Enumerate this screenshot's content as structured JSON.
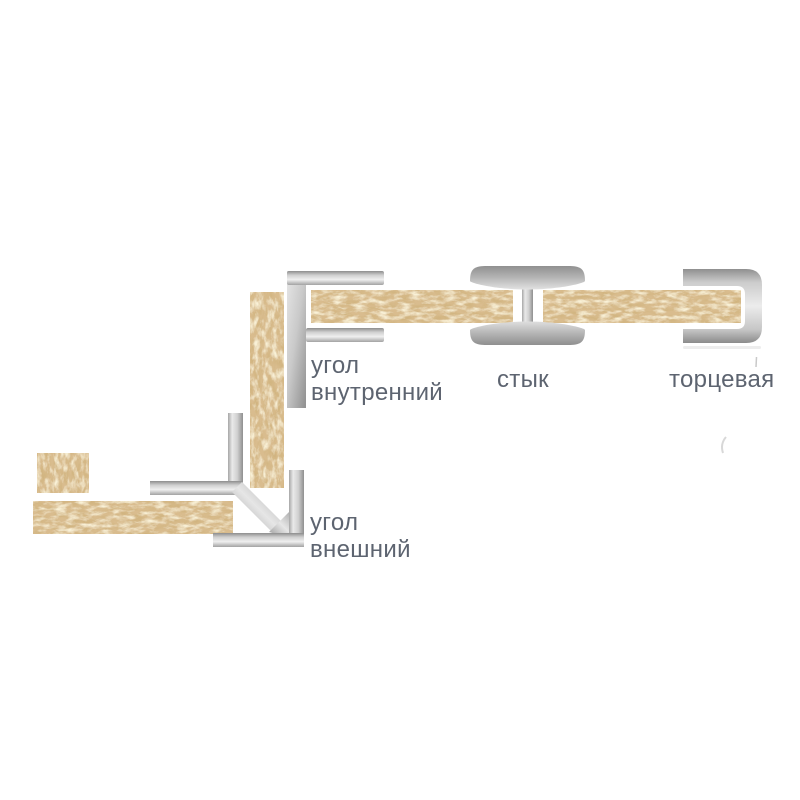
{
  "canvas": {
    "width": 800,
    "height": 800,
    "background": "#ffffff"
  },
  "palette": {
    "chipboard_base": "#d9bc8e",
    "chipboard_dark": "#a37538",
    "chipboard_light": "#f0deA8",
    "metal_light": "#efefef",
    "metal_mid": "#c2c2c2",
    "metal_dark": "#8e8e8e",
    "label_text": "#5d6470"
  },
  "labels": {
    "inner_corner": {
      "line1": "угол",
      "line2": "внутренний"
    },
    "joint": {
      "line1": "стык"
    },
    "end_cap": {
      "line1": "торцевая"
    },
    "outer_corner": {
      "line1": "угол",
      "line2": "внешний"
    }
  }
}
